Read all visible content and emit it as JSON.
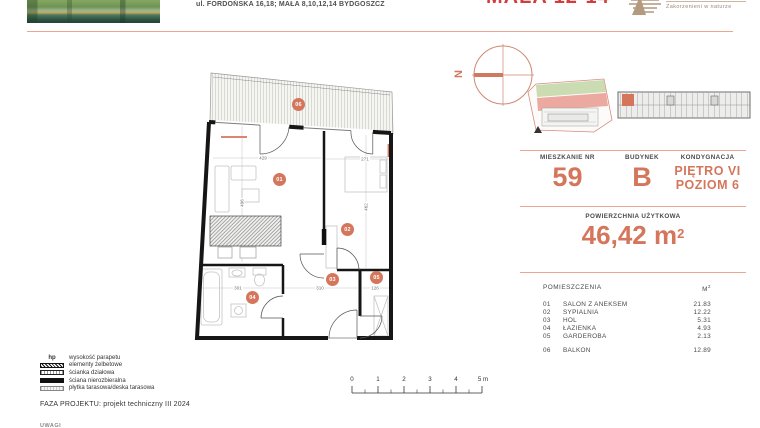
{
  "header": {
    "address": "ul. FORDOŃSKA 16,18; MAŁA 8,10,12,14 BYDGOSZCZ",
    "project_title": "MAŁA 12-14",
    "logo_tagline": "Zakorzenieni w naturze"
  },
  "compass": {
    "north": "N"
  },
  "info": {
    "apartment": {
      "label": "MIESZKANIE NR",
      "value": "59"
    },
    "building": {
      "label": "BUDYNEK",
      "value": "B"
    },
    "floor": {
      "label": "KONDYGNACJA",
      "line1": "PIĘTRO VI",
      "line2": "POZIOM 6"
    },
    "area": {
      "label": "POWIERZCHNIA UŻYTKOWA",
      "value": "46,42 m",
      "sup": "2"
    }
  },
  "rooms": {
    "header_name": "POMIESZCZENIA",
    "header_unit": {
      "text": "M",
      "sup": "2"
    },
    "items": [
      {
        "no": "01",
        "name": "SALON Z ANEKSEM",
        "area": "21.83"
      },
      {
        "no": "02",
        "name": "SYPIALNIA",
        "area": "12.22"
      },
      {
        "no": "03",
        "name": "HOL",
        "area": "5.31"
      },
      {
        "no": "04",
        "name": "ŁAZIENKA",
        "area": "4.93"
      },
      {
        "no": "05",
        "name": "GARDEROBA",
        "area": "2.13"
      }
    ],
    "external": {
      "no": "06",
      "name": "BALKON",
      "area": "12.89"
    }
  },
  "plan": {
    "room_labels": [
      "01",
      "02",
      "03",
      "04",
      "05",
      "06"
    ],
    "dimensions": [
      "429",
      "271",
      "496",
      "462",
      "310",
      "301",
      "126"
    ]
  },
  "legend": {
    "items": [
      {
        "symbol": "hp",
        "label": "wysokość parapetu"
      },
      {
        "label": "elementy żelbetowe"
      },
      {
        "label": "ścianka działowa"
      },
      {
        "label": "ściana nierozbieralna"
      },
      {
        "label": "płytka tarasowa/deska tarasowa"
      }
    ],
    "phase": "FAZA PROJEKTU: projekt techniczny III 2024",
    "notes_label": "UWAGI"
  },
  "scalebar": {
    "ticks": [
      "0",
      "1",
      "2",
      "3",
      "4",
      "5 m"
    ]
  },
  "colors": {
    "accent": "#D4765C",
    "title_red": "#D23C3C",
    "divider": "#EBA78F"
  }
}
